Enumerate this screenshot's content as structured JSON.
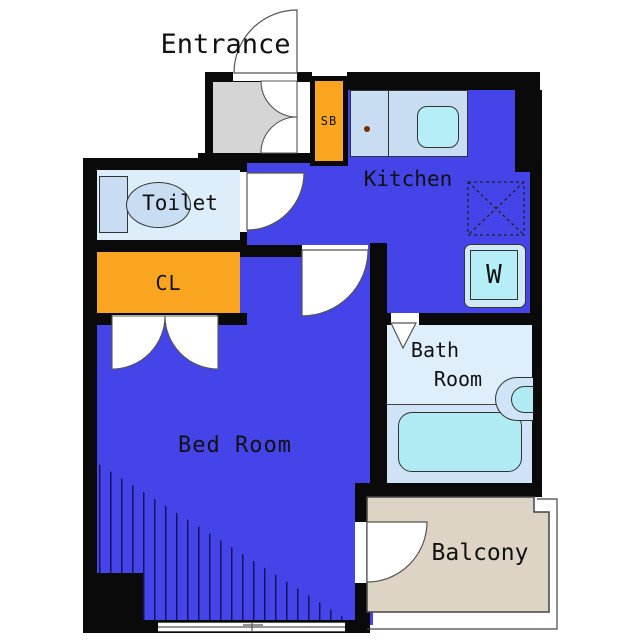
{
  "title": "1K apartment floor plan",
  "rooms": {
    "entrance": {
      "label": "Entrance"
    },
    "shoe_box": {
      "label": "SB"
    },
    "toilet": {
      "label": "Toilet"
    },
    "closet": {
      "label": "CL"
    },
    "kitchen": {
      "label": "Kitchen"
    },
    "washer": {
      "label": "W"
    },
    "bathroom": {
      "label_line1": "Bath",
      "label_line2": "Room"
    },
    "bedroom": {
      "label": "Bed Room"
    },
    "balcony": {
      "label": "Balcony"
    }
  },
  "colors": {
    "floor_blue": "#4444e8",
    "wall": "#0a0a0a",
    "entrance_gray": "#d5d5d5",
    "closet_orange": "#f9a51f",
    "balcony_beige": "#ddd4c6",
    "room_lightblue": "#ddedfa",
    "fixture_blue": "#c9ddf2",
    "sink_cyan": "#b5eef6",
    "tub_cyan": "#b0ebf3",
    "text": "#111111"
  }
}
